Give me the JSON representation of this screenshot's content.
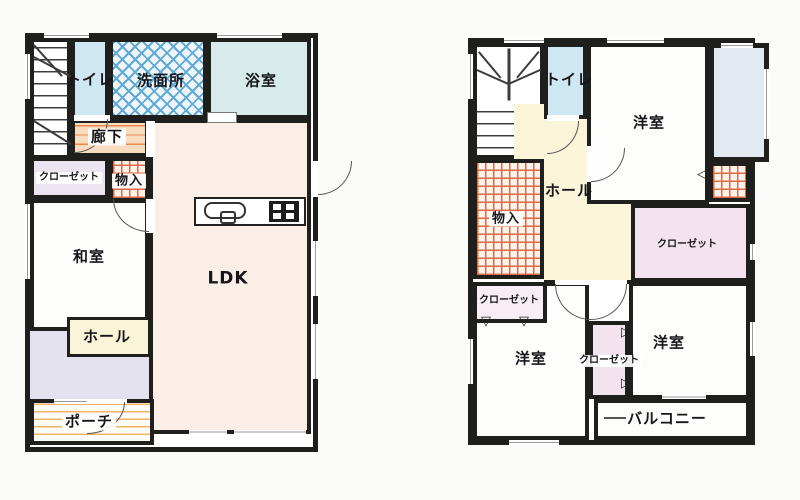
{
  "colors": {
    "wall": "#1f1f1d",
    "page_bg": "#fbfbf9",
    "room_white": "#fdfdfb",
    "toilet_blue": "#cfe7f3",
    "bath_cyan": "#d7ebea",
    "washroom_blue": "#5fa9d6",
    "washroom_bg": "#eef6fb",
    "ldk_pink": "#faeee7",
    "corridor_peach": "#f8dcc0",
    "corridor_line": "#e8894c",
    "lavender": "#e2e1ed",
    "cream": "#faf5d9",
    "closet_lavender": "#ece5f1",
    "closet_pink": "#f3e3ee",
    "blue_gray": "#e3e9f1",
    "grid_red": "#dd6a45",
    "grid_bg": "#fdf4ee",
    "porch_line": "#f2b269"
  },
  "floor1": {
    "rooms": {
      "toilet": "トイレ",
      "washroom": "洗面所",
      "bathroom": "浴室",
      "corridor": "廊下",
      "closet": "クローゼット",
      "storage": "物入",
      "japanese_room": "和室",
      "ldk": "LDK",
      "hall": "ホール",
      "porch": "ポーチ"
    }
  },
  "floor2": {
    "rooms": {
      "toilet": "トイレ",
      "bedroom_top": "洋室",
      "hall": "ホール",
      "storage": "物入",
      "closet_right": "クローゼット",
      "closet_left": "クローゼット",
      "closet_middle": "クローゼット",
      "bedroom_left": "洋室",
      "bedroom_right": "洋室",
      "balcony": "バルコニー"
    }
  },
  "icons": {
    "fold_door_down": "▽",
    "fold_door_right": "▷",
    "fold_door_left": "◁"
  }
}
